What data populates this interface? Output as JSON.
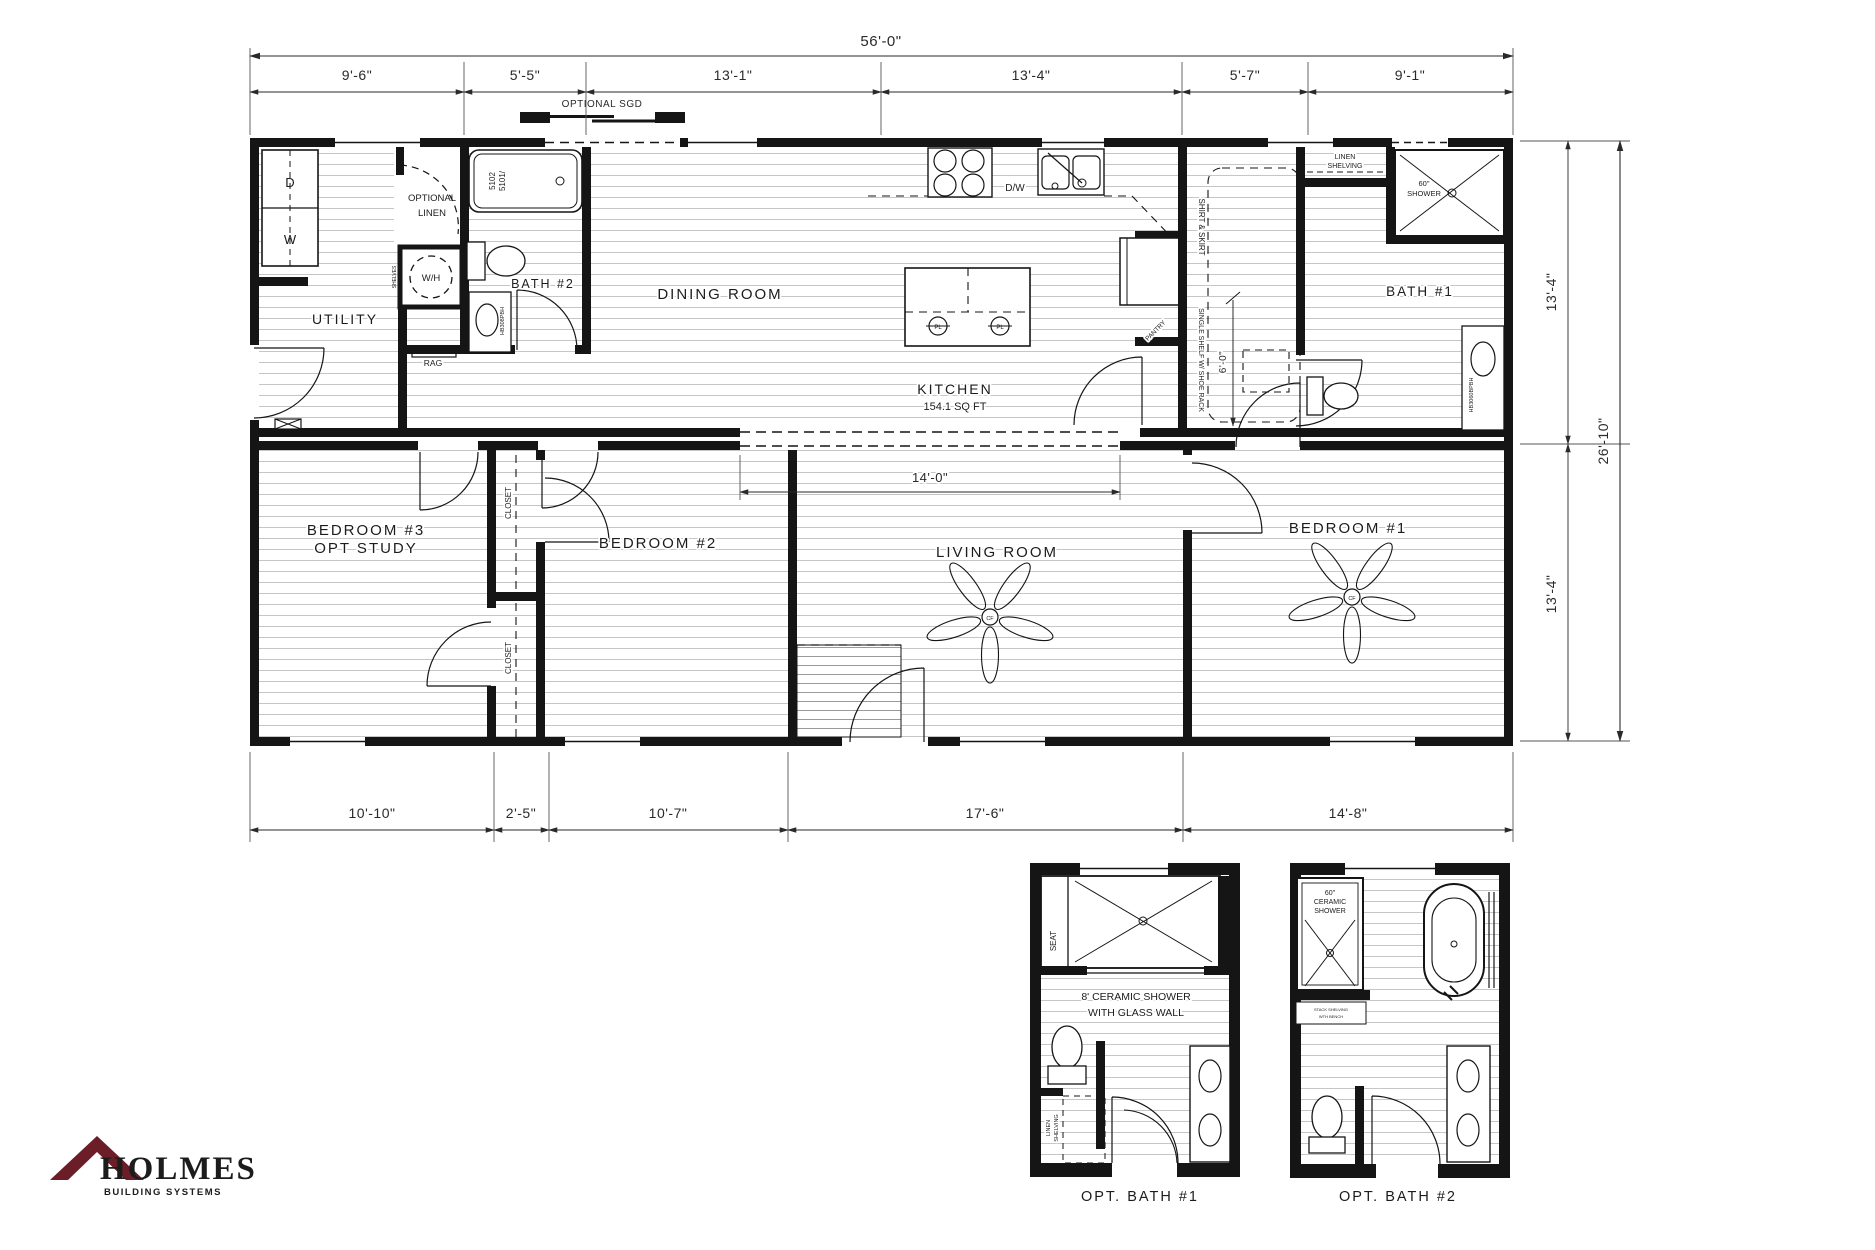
{
  "colors": {
    "ink": "#1a1a1a",
    "hatch": "#c6c6c6",
    "dimension": "#2a2a2a",
    "logo": "#6b1d28"
  },
  "logo": {
    "name": "HOLMES",
    "tagline": "BUILDING SYSTEMS"
  },
  "dimensions": {
    "overall_width": "56'-0\"",
    "top": [
      "9'-6\"",
      "5'-5\"",
      "13'-1\"",
      "13'-4\"",
      "5'-7\"",
      "9'-1\""
    ],
    "bottom": [
      "10'-10\"",
      "2'-5\"",
      "10'-7\"",
      "17'-6\"",
      "14'-8\""
    ],
    "right_upper": "13'-4\"",
    "right_overall": "26'-10\"",
    "right_lower": "13'-4\"",
    "kitchen_opening": "14'-0\"",
    "closet_depth": "6'-0\""
  },
  "annotations": {
    "optional_sgd": "OPTIONAL SGD",
    "optional_linen_a": "OPTIONAL",
    "optional_linen_b": "LINEN"
  },
  "rooms": {
    "utility": "UTILITY",
    "dining": "DINING ROOM",
    "kitchen": "KITCHEN",
    "kitchen_area": "154.1 SQ FT",
    "living": "LIVING ROOM",
    "bedroom1": "BEDROOM #1",
    "bedroom2": "BEDROOM #2",
    "bedroom3": "BEDROOM #3",
    "bedroom3_alt": "OPT STUDY",
    "bath1": "BATH #1",
    "bath2": "BATH #2",
    "closet": "CLOSET"
  },
  "fixtures": {
    "dryer": "D",
    "washer": "W",
    "water_heater": "W/H",
    "dishwasher": "D/W",
    "pendant_light": "PL",
    "ceiling_fan": "CF",
    "rag": "RAG",
    "shelves": "SHELVES",
    "tub_model_a": "5102",
    "tub_model_b": "5101/",
    "vanity_bath2": "HB308PBH",
    "vanity_bath1": "HB3060BPBH",
    "shower_size": "60\"",
    "shower_word": "SHOWER",
    "pantry": "PANTRY",
    "shirt_skirt": "SHIRT & SKIRT",
    "single_shelf": "SINGLE SHELF W/ SHOE RACK",
    "linen_a": "LINEN",
    "linen_b": "SHELVING"
  },
  "opt_bath1": {
    "title": "OPT. BATH #1",
    "seat": "SEAT",
    "caption_a": "8' CERAMIC SHOWER",
    "caption_b": "WITH GLASS WALL",
    "linen_a": "LINEN",
    "linen_b": "SHELVING"
  },
  "opt_bath2": {
    "title": "OPT. BATH #2",
    "shower_a": "60\"",
    "shower_b": "CERAMIC",
    "shower_c": "SHOWER",
    "shelf_a": "STACK SHELVING",
    "shelf_b": "WTH BENCH"
  }
}
